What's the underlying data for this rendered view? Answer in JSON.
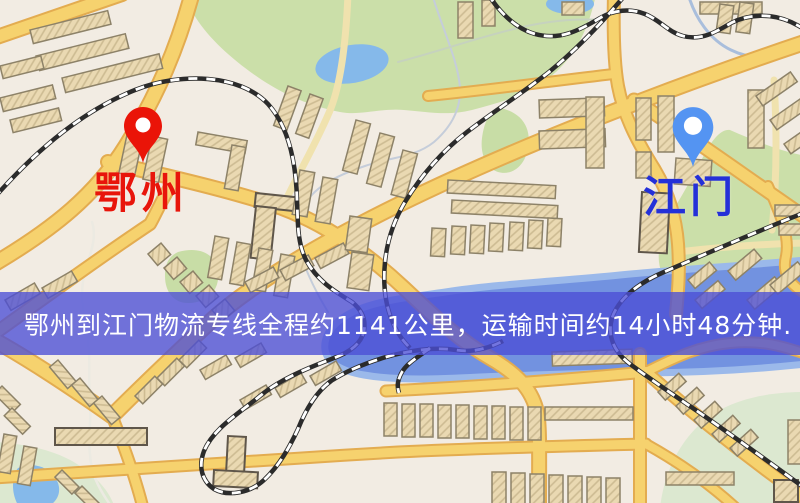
{
  "banner": {
    "text": "鄂州到江门物流专线全程约1141公里，运输时间约14小时48分钟."
  },
  "markers": {
    "origin": {
      "label": "鄂州",
      "icon": "red-map-pin-icon"
    },
    "destination": {
      "label": "江门",
      "icon": "blue-map-pin-icon"
    }
  },
  "colors": {
    "banner_bg": "rgba(76,78,214,0.78)",
    "banner_text": "#ffffff",
    "origin_pin": "#ea1408",
    "origin_label": "#e8150b",
    "destination_pin": "#5494f2",
    "destination_label": "#2430d8",
    "road": "#f6d26e",
    "road_casing": "#e3ac50",
    "railway": "#2b2b2b",
    "water": "#7292e0",
    "lake": "#85b9ea",
    "park": "#cbdfa9",
    "park_pale": "#dce8d0",
    "building": "#ead9b2",
    "building_outline": "#8d8268",
    "map_background": "#f2ece3"
  }
}
